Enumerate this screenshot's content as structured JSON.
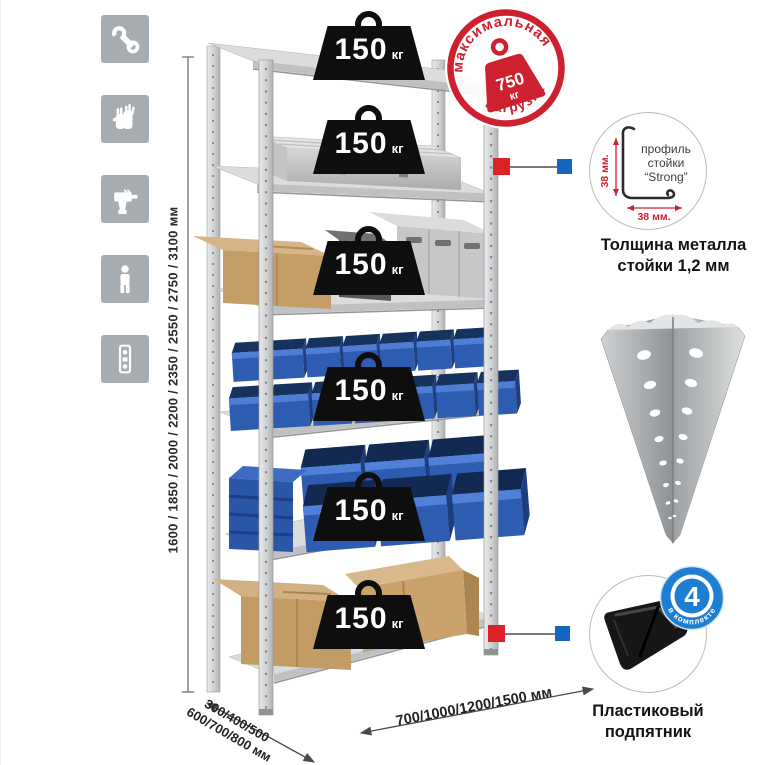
{
  "left_icons": {
    "items": [
      "wrench",
      "gloves",
      "drill",
      "person",
      "level"
    ]
  },
  "dimensions": {
    "height_label": "1600 / 1850 / 2000 / 2200 / 2350 / 2550 / 2750 / 3100 мм",
    "depth_line1": "300/400/500",
    "depth_line2": "600/700/800 мм",
    "width_label": "700/1000/1200/1500 мм"
  },
  "rack": {
    "shelf_count": 6,
    "shelf_load": {
      "value": "150",
      "unit": "кг"
    }
  },
  "max_load_stamp": {
    "arc_top": "максимальная",
    "arc_bottom": "нагрузка",
    "value": "750",
    "unit": "кг"
  },
  "post_profile": {
    "label_line1": "профиль",
    "label_line2": "стойки",
    "label_line3": "“Strong”",
    "dim_vertical": "38 мм.",
    "dim_horizontal": "38 мм.",
    "caption_line1": "Толщина металла",
    "caption_line2": "стойки 1,2 мм"
  },
  "foot_detail": {
    "badge_number": "4",
    "badge_arc_text": "в комплекте",
    "caption_line1": "Пластиковый",
    "caption_line2": "подпятник"
  },
  "colors": {
    "accent_red": "#d1232a",
    "accent_blue": "#1565c0",
    "bin_blue": "#2e5cb0",
    "metal_gray": "#c9cbcd",
    "icon_bg": "#a7acb1",
    "weight_black": "#0e0e0e"
  }
}
